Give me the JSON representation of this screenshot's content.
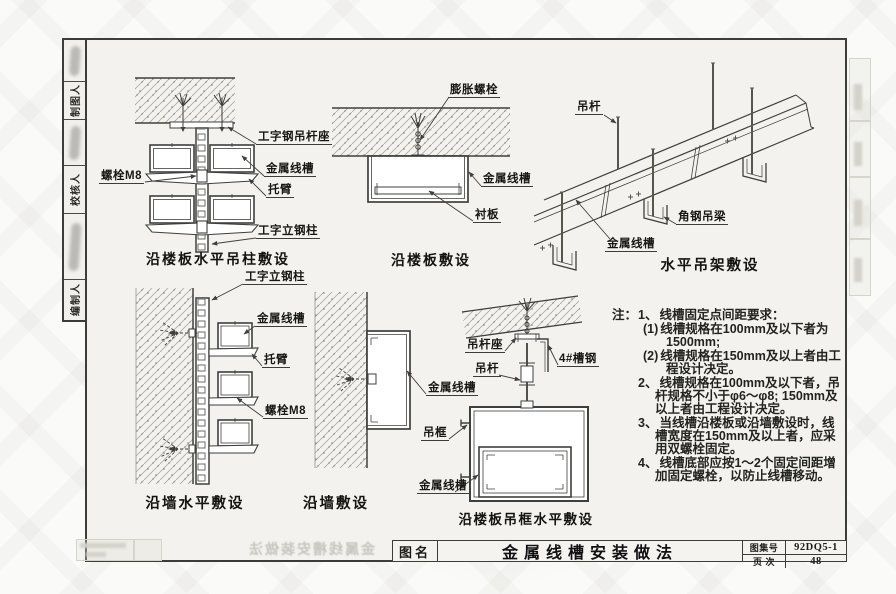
{
  "sidebar": {
    "cells": [
      {
        "label": "制图人"
      },
      {
        "label": "校核人"
      },
      {
        "label": "编制人"
      }
    ]
  },
  "diagrams": {
    "d1": {
      "caption": "沿楼板水平吊柱敷设",
      "labels": {
        "bolt_m8": "螺栓M8",
        "hanger_seat": "工字钢吊杆座",
        "tray": "金属线槽",
        "bracket_arm": "托臂",
        "steel_column": "工字立钢柱"
      }
    },
    "d2": {
      "caption": "沿楼板敷设",
      "labels": {
        "expansion_bolt": "膨胀螺栓",
        "tray": "金属线槽",
        "liner_plate": "衬板"
      }
    },
    "d3": {
      "caption": "水平吊架敷设",
      "labels": {
        "hanger_rod": "吊杆",
        "angle_beam": "角钢吊梁",
        "tray": "金属线槽"
      }
    },
    "d4": {
      "caption": "沿墙水平敷设",
      "labels": {
        "steel_column": "工字立钢柱",
        "tray": "金属线槽",
        "bracket_arm": "托臂",
        "bolt_m8": "螺栓M8"
      }
    },
    "d5": {
      "caption": "沿墙敷设",
      "labels": {
        "tray": "金属线槽"
      }
    },
    "d6": {
      "caption": "沿楼板吊框水平敷设",
      "labels": {
        "rod_seat": "吊杆座",
        "channel_steel": "4#槽钢",
        "hanger_rod": "吊杆",
        "hanger_frame": "吊框",
        "tray_bottom": "金属线槽"
      }
    }
  },
  "notes": {
    "heading": "注：",
    "items": [
      {
        "num": "1、",
        "text": "线槽固定点间距要求："
      },
      {
        "num": "(1)",
        "text": "线槽规格在100mm及以下者为1500mm;"
      },
      {
        "num": "(2)",
        "text": "线槽规格在150mm及以上者由工程设计决定。"
      },
      {
        "num": "2、",
        "text": "线槽规格在100mm及以下者，吊杆规格不小于φ6～φ8; 150mm及以上者由工程设计决定。"
      },
      {
        "num": "3、",
        "text": "当线槽沿楼板或沿墙敷设时，线槽宽度在150mm及以上者，应采用双螺栓固定。"
      },
      {
        "num": "4、",
        "text": "线槽底部应按1～2个固定间距增加固定螺栓，以防止线槽移动。"
      }
    ]
  },
  "title_block": {
    "name_label": "图名",
    "drawing_title": "金属线槽安装做法",
    "atlas_label": "图集号",
    "atlas_number": "92DQ5-1",
    "page_label": "页 次",
    "page_number": "48"
  },
  "ghost": {
    "bleed_title": "金属线槽安装做法"
  }
}
